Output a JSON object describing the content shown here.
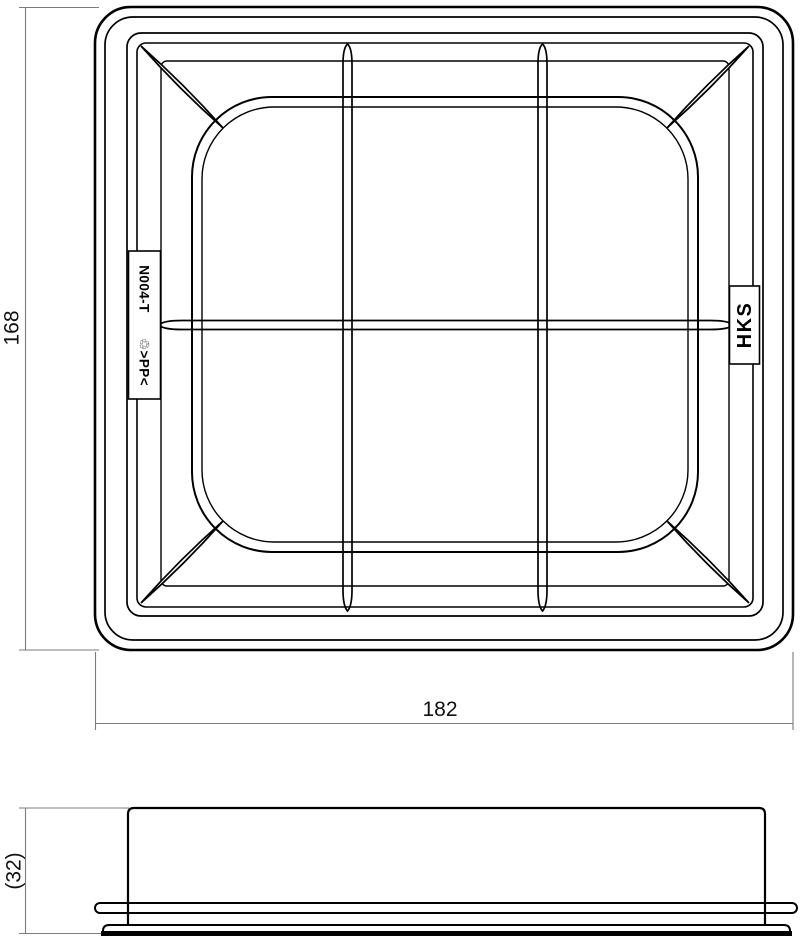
{
  "drawing": {
    "type": "technical-dimension-drawing",
    "views": {
      "top_view": {
        "part_plate": {
          "part_number": "N004-T",
          "material_mark": "♲>PP<"
        },
        "brand_plate": {
          "brand": "HKS"
        }
      },
      "side_view": {}
    },
    "dimensions": {
      "overall_height": "168",
      "overall_width": "182",
      "side_height": "(32)"
    },
    "colors": {
      "object_line": "#000000",
      "dimension_line": "#7b7b7b",
      "text": "#111111",
      "background": "#ffffff"
    }
  }
}
